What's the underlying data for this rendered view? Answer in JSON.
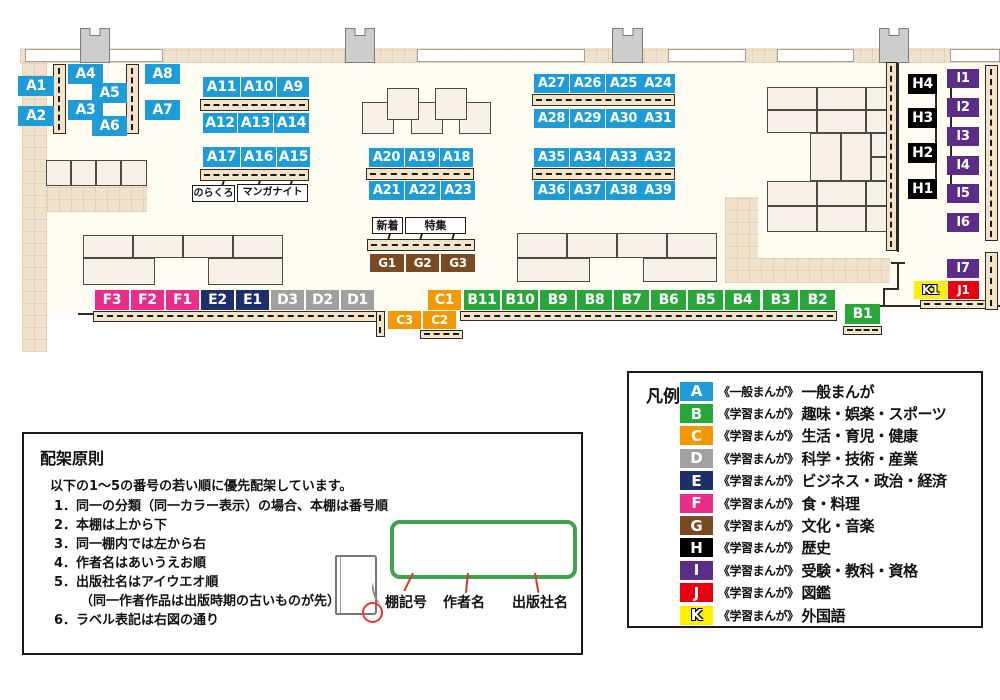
{
  "map": {
    "labels": [
      {
        "id": "A1",
        "x": 18,
        "y": 76,
        "w": 36,
        "h": 20
      },
      {
        "id": "A2",
        "x": 18,
        "y": 106,
        "w": 36,
        "h": 20
      },
      {
        "id": "A4",
        "x": 68,
        "y": 64,
        "w": 35,
        "h": 20
      },
      {
        "id": "A5",
        "x": 92,
        "y": 83,
        "w": 35,
        "h": 20
      },
      {
        "id": "A3",
        "x": 68,
        "y": 100,
        "w": 35,
        "h": 20
      },
      {
        "id": "A6",
        "x": 92,
        "y": 116,
        "w": 35,
        "h": 20
      },
      {
        "id": "A8",
        "x": 145,
        "y": 64,
        "w": 35,
        "h": 20
      },
      {
        "id": "A7",
        "x": 145,
        "y": 100,
        "w": 35,
        "h": 20
      },
      {
        "id": "A11",
        "x": 203,
        "y": 77,
        "w": 37,
        "h": 20
      },
      {
        "id": "A10",
        "x": 241,
        "y": 77,
        "w": 35,
        "h": 20
      },
      {
        "id": "A9",
        "x": 277,
        "y": 77,
        "w": 32,
        "h": 20
      },
      {
        "id": "A12",
        "x": 203,
        "y": 113,
        "w": 34,
        "h": 20
      },
      {
        "id": "A13",
        "x": 238,
        "y": 113,
        "w": 35,
        "h": 20
      },
      {
        "id": "A14",
        "x": 274,
        "y": 113,
        "w": 35,
        "h": 20
      },
      {
        "id": "A17",
        "x": 203,
        "y": 147,
        "w": 37,
        "h": 20
      },
      {
        "id": "A16",
        "x": 241,
        "y": 147,
        "w": 35,
        "h": 20
      },
      {
        "id": "A15",
        "x": 277,
        "y": 147,
        "w": 33,
        "h": 20
      },
      {
        "id": "A20",
        "x": 369,
        "y": 148,
        "w": 35,
        "h": 19
      },
      {
        "id": "A19",
        "x": 405,
        "y": 148,
        "w": 34,
        "h": 19
      },
      {
        "id": "A18",
        "x": 440,
        "y": 148,
        "w": 33,
        "h": 19
      },
      {
        "id": "A21",
        "x": 369,
        "y": 181,
        "w": 35,
        "h": 19
      },
      {
        "id": "A22",
        "x": 405,
        "y": 181,
        "w": 35,
        "h": 19
      },
      {
        "id": "A23",
        "x": 441,
        "y": 181,
        "w": 34,
        "h": 19
      },
      {
        "id": "A27",
        "x": 534,
        "y": 74,
        "w": 35,
        "h": 19
      },
      {
        "id": "A26",
        "x": 570,
        "y": 74,
        "w": 35,
        "h": 19
      },
      {
        "id": "A25",
        "x": 606,
        "y": 74,
        "w": 35,
        "h": 19
      },
      {
        "id": "A24",
        "x": 641,
        "y": 74,
        "w": 34,
        "h": 19
      },
      {
        "id": "A28",
        "x": 534,
        "y": 109,
        "w": 35,
        "h": 19
      },
      {
        "id": "A29",
        "x": 570,
        "y": 109,
        "w": 35,
        "h": 19
      },
      {
        "id": "A30",
        "x": 606,
        "y": 109,
        "w": 35,
        "h": 19
      },
      {
        "id": "A31",
        "x": 641,
        "y": 109,
        "w": 34,
        "h": 19
      },
      {
        "id": "A35",
        "x": 534,
        "y": 148,
        "w": 35,
        "h": 19
      },
      {
        "id": "A34",
        "x": 570,
        "y": 148,
        "w": 35,
        "h": 19
      },
      {
        "id": "A33",
        "x": 606,
        "y": 148,
        "w": 35,
        "h": 19
      },
      {
        "id": "A32",
        "x": 641,
        "y": 148,
        "w": 34,
        "h": 19
      },
      {
        "id": "A36",
        "x": 534,
        "y": 181,
        "w": 35,
        "h": 19
      },
      {
        "id": "A37",
        "x": 570,
        "y": 181,
        "w": 35,
        "h": 19
      },
      {
        "id": "A38",
        "x": 606,
        "y": 181,
        "w": 35,
        "h": 19
      },
      {
        "id": "A39",
        "x": 641,
        "y": 181,
        "w": 34,
        "h": 19
      },
      {
        "id": "G1",
        "x": 370,
        "y": 254,
        "w": 34,
        "h": 18
      },
      {
        "id": "G2",
        "x": 406,
        "y": 254,
        "w": 33,
        "h": 18
      },
      {
        "id": "G3",
        "x": 441,
        "y": 254,
        "w": 34,
        "h": 18
      },
      {
        "id": "F3",
        "x": 95,
        "y": 290,
        "w": 34,
        "h": 20
      },
      {
        "id": "F2",
        "x": 131,
        "y": 290,
        "w": 33,
        "h": 20
      },
      {
        "id": "F1",
        "x": 166,
        "y": 290,
        "w": 33,
        "h": 20
      },
      {
        "id": "E2",
        "x": 201,
        "y": 290,
        "w": 33,
        "h": 20
      },
      {
        "id": "E1",
        "x": 236,
        "y": 290,
        "w": 33,
        "h": 20
      },
      {
        "id": "D3",
        "x": 271,
        "y": 290,
        "w": 33,
        "h": 20
      },
      {
        "id": "D2",
        "x": 306,
        "y": 290,
        "w": 33,
        "h": 20
      },
      {
        "id": "D1",
        "x": 341,
        "y": 290,
        "w": 33,
        "h": 20
      },
      {
        "id": "C1",
        "x": 428,
        "y": 290,
        "w": 33,
        "h": 20
      },
      {
        "id": "B11",
        "x": 464,
        "y": 290,
        "w": 36,
        "h": 20
      },
      {
        "id": "B10",
        "x": 502,
        "y": 290,
        "w": 36,
        "h": 20
      },
      {
        "id": "B9",
        "x": 540,
        "y": 290,
        "w": 35,
        "h": 20
      },
      {
        "id": "B8",
        "x": 577,
        "y": 290,
        "w": 35,
        "h": 20
      },
      {
        "id": "B7",
        "x": 614,
        "y": 290,
        "w": 35,
        "h": 20
      },
      {
        "id": "B6",
        "x": 651,
        "y": 290,
        "w": 35,
        "h": 20
      },
      {
        "id": "B5",
        "x": 688,
        "y": 290,
        "w": 35,
        "h": 20
      },
      {
        "id": "B4",
        "x": 725,
        "y": 290,
        "w": 35,
        "h": 20
      },
      {
        "id": "B3",
        "x": 763,
        "y": 290,
        "w": 35,
        "h": 20
      },
      {
        "id": "B2",
        "x": 800,
        "y": 290,
        "w": 35,
        "h": 20
      },
      {
        "id": "C3",
        "x": 388,
        "y": 311,
        "w": 33,
        "h": 18
      },
      {
        "id": "C2",
        "x": 423,
        "y": 311,
        "w": 33,
        "h": 18
      },
      {
        "id": "B1",
        "x": 845,
        "y": 304,
        "w": 35,
        "h": 20
      },
      {
        "id": "H4",
        "x": 908,
        "y": 74,
        "w": 29,
        "h": 20
      },
      {
        "id": "H3",
        "x": 908,
        "y": 108,
        "w": 29,
        "h": 20
      },
      {
        "id": "H2",
        "x": 908,
        "y": 143,
        "w": 29,
        "h": 20
      },
      {
        "id": "H1",
        "x": 908,
        "y": 179,
        "w": 29,
        "h": 20
      },
      {
        "id": "I1",
        "x": 947,
        "y": 69,
        "w": 32,
        "h": 19
      },
      {
        "id": "I2",
        "x": 947,
        "y": 98,
        "w": 32,
        "h": 19
      },
      {
        "id": "I3",
        "x": 947,
        "y": 127,
        "w": 32,
        "h": 19
      },
      {
        "id": "I4",
        "x": 947,
        "y": 156,
        "w": 32,
        "h": 19
      },
      {
        "id": "I5",
        "x": 947,
        "y": 184,
        "w": 32,
        "h": 19
      },
      {
        "id": "I6",
        "x": 947,
        "y": 213,
        "w": 32,
        "h": 19
      },
      {
        "id": "I7",
        "x": 947,
        "y": 259,
        "w": 32,
        "h": 19
      },
      {
        "id": "K1",
        "x": 914,
        "y": 281,
        "w": 33,
        "h": 18
      },
      {
        "id": "J1",
        "x": 948,
        "y": 281,
        "w": 31,
        "h": 18
      }
    ],
    "tags": [
      {
        "text": "のらくろ",
        "x": 192,
        "y": 185,
        "w": 43,
        "h": 17,
        "fs": 10
      },
      {
        "text": "マンガナイト",
        "x": 237,
        "y": 184,
        "w": 71,
        "h": 18,
        "fs": 10
      },
      {
        "text": "新着",
        "x": 372,
        "y": 217,
        "w": 31,
        "h": 17,
        "fs": 11
      },
      {
        "text": "特集",
        "x": 405,
        "y": 217,
        "w": 61,
        "h": 17,
        "fs": 11
      }
    ]
  },
  "legend": {
    "title": "凡例",
    "entries": [
      {
        "letter": "A",
        "color": "#1E9CD8",
        "maker": "《一般まんが》",
        "category": "一般まんが",
        "outline": false
      },
      {
        "letter": "B",
        "color": "#27A639",
        "maker": "《学習まんが》",
        "category": "趣味・娯楽・スポーツ",
        "outline": false
      },
      {
        "letter": "C",
        "color": "#F39800",
        "maker": "《学習まんが》",
        "category": "生活・育児・健康",
        "outline": false
      },
      {
        "letter": "D",
        "color": "#9FA0A0",
        "maker": "《学習まんが》",
        "category": "科学・技術・産業",
        "outline": false
      },
      {
        "letter": "E",
        "color": "#1D2E68",
        "maker": "《学習まんが》",
        "category": "ビジネス・政治・経済",
        "outline": false
      },
      {
        "letter": "F",
        "color": "#EA2D8A",
        "maker": "《学習まんが》",
        "category": "食・料理",
        "outline": false
      },
      {
        "letter": "G",
        "color": "#7A4B23",
        "maker": "《学習まんが》",
        "category": "文化・音楽",
        "outline": false
      },
      {
        "letter": "H",
        "color": "#000000",
        "maker": "《学習まんが》",
        "category": "歴史",
        "outline": false
      },
      {
        "letter": "I",
        "color": "#5B2D86",
        "maker": "《学習まんが》",
        "category": "受験・教科・資格",
        "outline": false
      },
      {
        "letter": "J",
        "color": "#E60012",
        "maker": "《学習まんが》",
        "category": "図鑑",
        "outline": false
      },
      {
        "letter": "K",
        "color": "#FFF000",
        "maker": "《学習まんが》",
        "category": "外国語",
        "outline": true
      }
    ]
  },
  "principles": {
    "title": "配架原則",
    "intro": "以下の1～5の番号の若い順に優先配架しています。",
    "items": [
      {
        "num": "1．",
        "text": "同一の分類（同一カラー表示）の場合、本棚は番号順",
        "indent": false
      },
      {
        "num": "2．",
        "text": "本棚は上から下",
        "indent": false
      },
      {
        "num": "3．",
        "text": "同一棚内では左から右",
        "indent": false
      },
      {
        "num": "4．",
        "text": "作者名はあいうえお順",
        "indent": false
      },
      {
        "num": "5．",
        "text": "出版社名はアイウエオ順",
        "indent": false
      },
      {
        "num": "",
        "text": "（同一作者作品は出版時期の古いものが先）",
        "indent": true
      },
      {
        "num": "6．",
        "text": "ラベル表記は右図の通り",
        "indent": false
      }
    ],
    "diagram": {
      "shelf_code": "A",
      "author": "あい",
      "publisher": "シヨ",
      "label_shelf": "棚記号",
      "label_author": "作者名",
      "label_publisher": "出版社名"
    }
  }
}
